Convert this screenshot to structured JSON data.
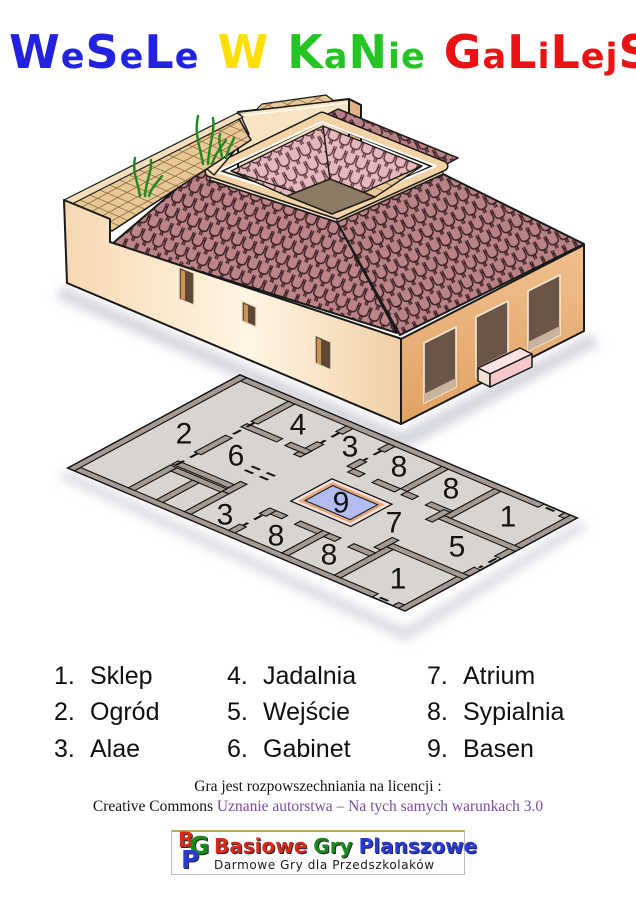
{
  "title": {
    "words": [
      {
        "text": "WeSeLe",
        "color": "#2222e0"
      },
      {
        "text": "W",
        "color": "#ffdf00"
      },
      {
        "text": "KaNie",
        "color": "#23c423"
      },
      {
        "text": "GaLiLejSKiej",
        "color": "#ea1212"
      }
    ]
  },
  "illustration": {
    "name": "isometric-roman-house",
    "wall_color": "#f9e0bd",
    "side_wall_color": "#eab67f",
    "roof_tile_color": "#b5797e",
    "inner_tile_color": "#e3b3b7",
    "terrace_color": "#e9c897",
    "pool_color": "#b3bcee"
  },
  "plan": {
    "rooms": [
      {
        "number": "2",
        "x": 184,
        "y": 434
      },
      {
        "number": "4",
        "x": 298,
        "y": 425
      },
      {
        "number": "3",
        "x": 350,
        "y": 447
      },
      {
        "number": "8",
        "x": 399,
        "y": 467
      },
      {
        "number": "8",
        "x": 451,
        "y": 489
      },
      {
        "number": "1",
        "x": 508,
        "y": 517
      },
      {
        "number": "6",
        "x": 236,
        "y": 456
      },
      {
        "number": "9",
        "x": 341,
        "y": 503
      },
      {
        "number": "7",
        "x": 394,
        "y": 523
      },
      {
        "number": "3",
        "x": 225,
        "y": 515
      },
      {
        "number": "8",
        "x": 276,
        "y": 536
      },
      {
        "number": "8",
        "x": 329,
        "y": 555
      },
      {
        "number": "5",
        "x": 457,
        "y": 547
      },
      {
        "number": "1",
        "x": 398,
        "y": 579
      }
    ]
  },
  "legend": {
    "items": [
      {
        "num": "1.",
        "name": "Sklep"
      },
      {
        "num": "2.",
        "name": "Ogród"
      },
      {
        "num": "3.",
        "name": "Alae"
      },
      {
        "num": "4.",
        "name": "Jadalnia"
      },
      {
        "num": "5.",
        "name": "Wejście"
      },
      {
        "num": "6.",
        "name": "Gabinet"
      },
      {
        "num": "7.",
        "name": "Atrium"
      },
      {
        "num": "8.",
        "name": "Sypialnia"
      },
      {
        "num": "9.",
        "name": "Basen"
      }
    ]
  },
  "footer": {
    "line1": "Gra jest rozpowszechniania na licencji :",
    "cc_prefix": "Creative Commons ",
    "cc_link": "Uznanie autorstwa – Na tych samych warunkach 3.0",
    "link_color": "#7b4a9e"
  },
  "logo": {
    "monogram": [
      {
        "letter": "B",
        "color": "#d42a1a"
      },
      {
        "letter": "G",
        "color": "#1a8a1a"
      },
      {
        "letter": "P",
        "color": "#2a3ad4"
      }
    ],
    "title_words": [
      {
        "text": "Basiowe",
        "color": "#d42a1a"
      },
      {
        "text": "Gry",
        "color": "#1a8a1a"
      },
      {
        "text": "Planszowe",
        "color": "#2a3ad4"
      }
    ],
    "subtitle": "Darmowe Gry dla Przedszkolaków"
  }
}
